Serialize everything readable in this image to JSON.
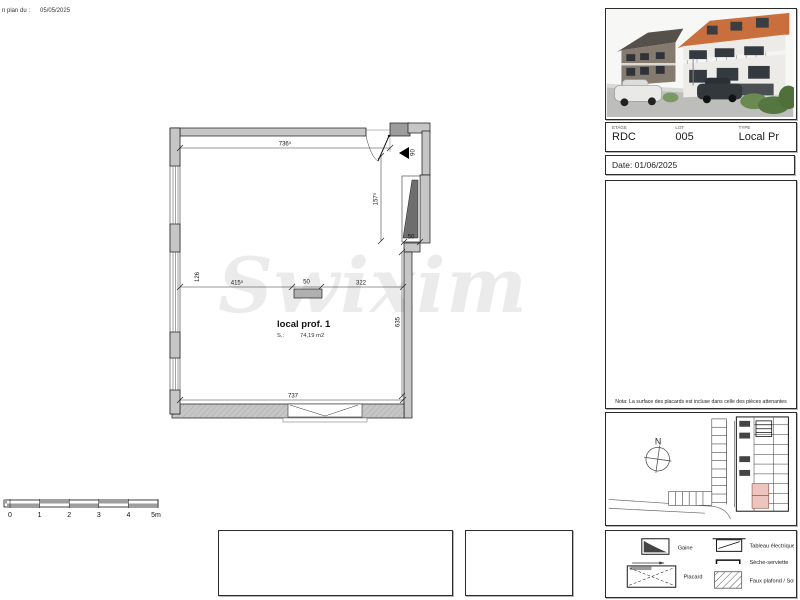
{
  "header": {
    "revision_text": "n plan du :",
    "revision_date": "05/05/2025"
  },
  "watermark": {
    "text": "Swixim"
  },
  "plan": {
    "room": {
      "name": "local prof. 1",
      "area_label": "S.:",
      "area_value": "74,19 m2"
    },
    "dimensions": {
      "top_width": "736⁵",
      "entry_depth": "157⁵",
      "entry_width": "90",
      "left_offset": "126",
      "seg_left": "415⁵",
      "seg_mid": "50",
      "seg_right": "322",
      "niche_width": "50",
      "right_height": "635",
      "bottom_width": "737"
    }
  },
  "scale_bar": {
    "ticks": [
      "0",
      "1",
      "2",
      "3",
      "4",
      "5m"
    ]
  },
  "panel": {
    "fields": [
      {
        "label": "ETAGE",
        "value": "RDC"
      },
      {
        "label": "LOT",
        "value": "005"
      },
      {
        "label": "TYPE",
        "value": "Local Pr"
      }
    ],
    "date": "Date: 01/06/2025",
    "nota": "Nota: La surface des placards est incluse dans celle des pièces attenantes",
    "north": "N"
  },
  "legend": {
    "items": [
      {
        "icon": "gaine",
        "label": "Gaine"
      },
      {
        "icon": "placard",
        "label": "Placard"
      },
      {
        "icon": "tableau-electrique",
        "label": "Tableau électrique"
      },
      {
        "icon": "seche-serviette",
        "label": "Sèche-serviette"
      },
      {
        "icon": "faux-plafond",
        "label": "Faux plafond / Soffite"
      }
    ]
  },
  "colors": {
    "highlight_room": "#edc5bf",
    "roof": "#c96f3e",
    "wall_fill": "#c6c6c6"
  }
}
